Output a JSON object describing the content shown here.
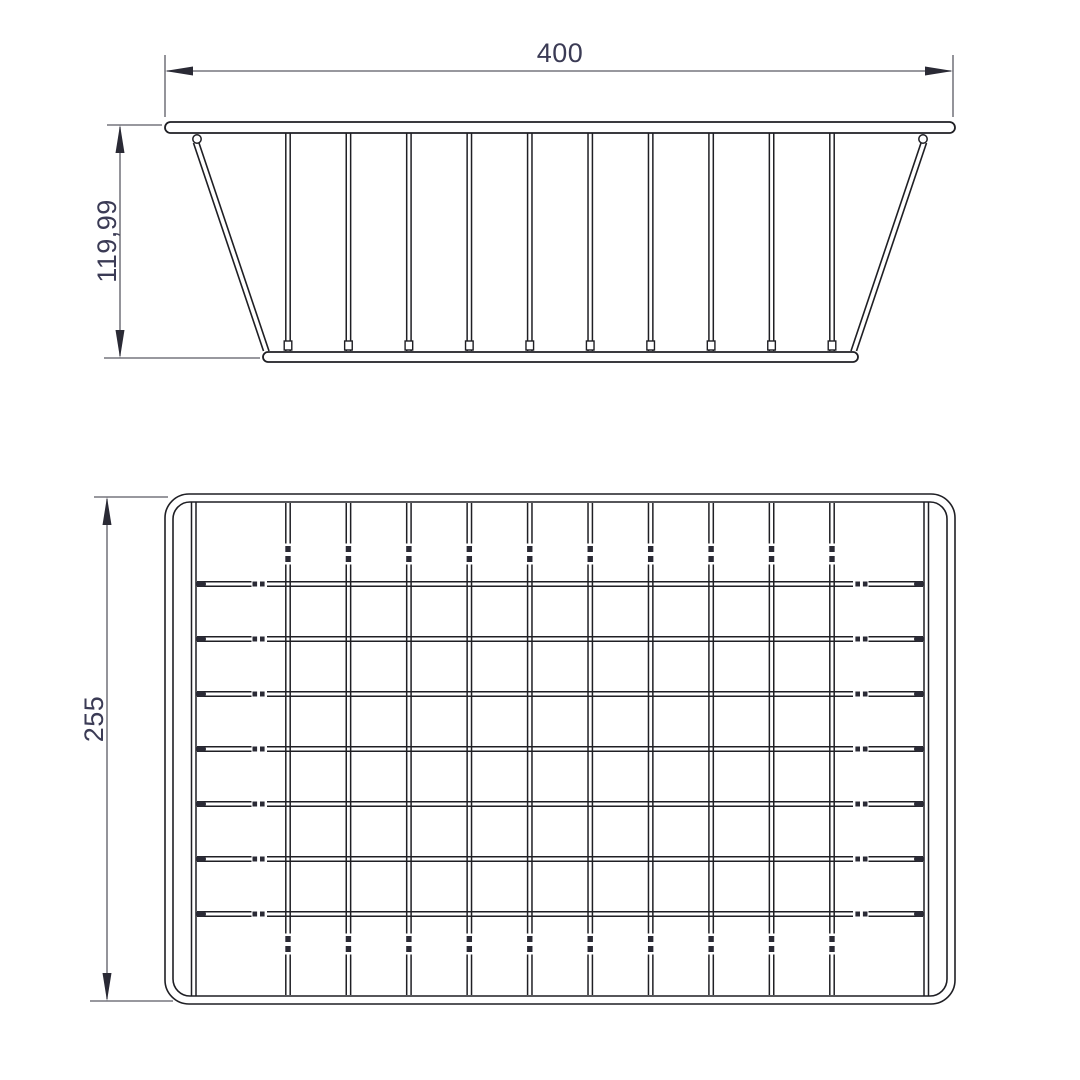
{
  "page": {
    "background": "#ffffff",
    "description": "Technical drawing of a tapered wire basket: front elevation view (top) and plan view from above (bottom) with linear dimensions in millimetres"
  },
  "drawing": {
    "colors": {
      "line": "#1f1f24",
      "dim_line": "#5a5a64",
      "arrow": "#2a2a35",
      "text": "#3b3b55"
    },
    "dimensions": {
      "front_width": "400",
      "front_height": "119,99",
      "plan_depth": "255"
    },
    "front_view": {
      "rim": {
        "x": 165,
        "y": 122,
        "width": 790,
        "height": 11
      },
      "base": {
        "x": 263,
        "y": 352,
        "width": 595,
        "height": 10
      },
      "vertical_wires": {
        "count": 10,
        "first_cx": 288,
        "last_cx": 832,
        "top_y": 133,
        "bottom_y": 351,
        "tick_y": 341,
        "pair_offset": 2.2
      },
      "slants": {
        "left": {
          "x_top": 196,
          "x_bottom": 266,
          "y_top": 143,
          "y_bottom": 351
        },
        "right": {
          "x_top": 924,
          "x_bottom": 854,
          "y_top": 143,
          "y_bottom": 351
        },
        "offset": 5.5
      },
      "hook_circles": [
        {
          "cx": 197,
          "cy": 139,
          "r": 4.2
        },
        {
          "cx": 923,
          "cy": 139,
          "r": 4.2
        }
      ]
    },
    "plan_view": {
      "outer": {
        "x": 165,
        "y": 494,
        "width": 790,
        "height": 510,
        "rx": 24
      },
      "inner": {
        "x": 173,
        "y": 502,
        "width": 774,
        "height": 494,
        "rx": 17
      },
      "wall_lines": {
        "left": [
          191.5,
          196
        ],
        "right": [
          924,
          928.5
        ],
        "top_y": 502,
        "bottom_y": 996
      },
      "vertical_wires": {
        "count": 10,
        "first_cx": 288,
        "last_cx": 832,
        "top_y": 503,
        "bottom_y": 995,
        "pair_offset": 2.2,
        "joint_bands": [
          {
            "mask_y": 543.5,
            "bead_y1": 546,
            "bead_y2": 556
          },
          {
            "mask_y": 933.5,
            "bead_y1": 936,
            "bead_y2": 946
          }
        ]
      },
      "horizontal_wires": {
        "count": 7,
        "first_cy": 584,
        "last_cy": 914,
        "left_x": 197,
        "right_x": 923,
        "pair_offset": 2.2,
        "end_caps": [
          196,
          914
        ],
        "bend_breaks": [
          {
            "mask_x": 251.5,
            "bead_x1": 252.5,
            "bead_x2": 260
          },
          {
            "mask_x": 853,
            "bead_x1": 855.4,
            "bead_x2": 862.9
          }
        ]
      }
    }
  }
}
